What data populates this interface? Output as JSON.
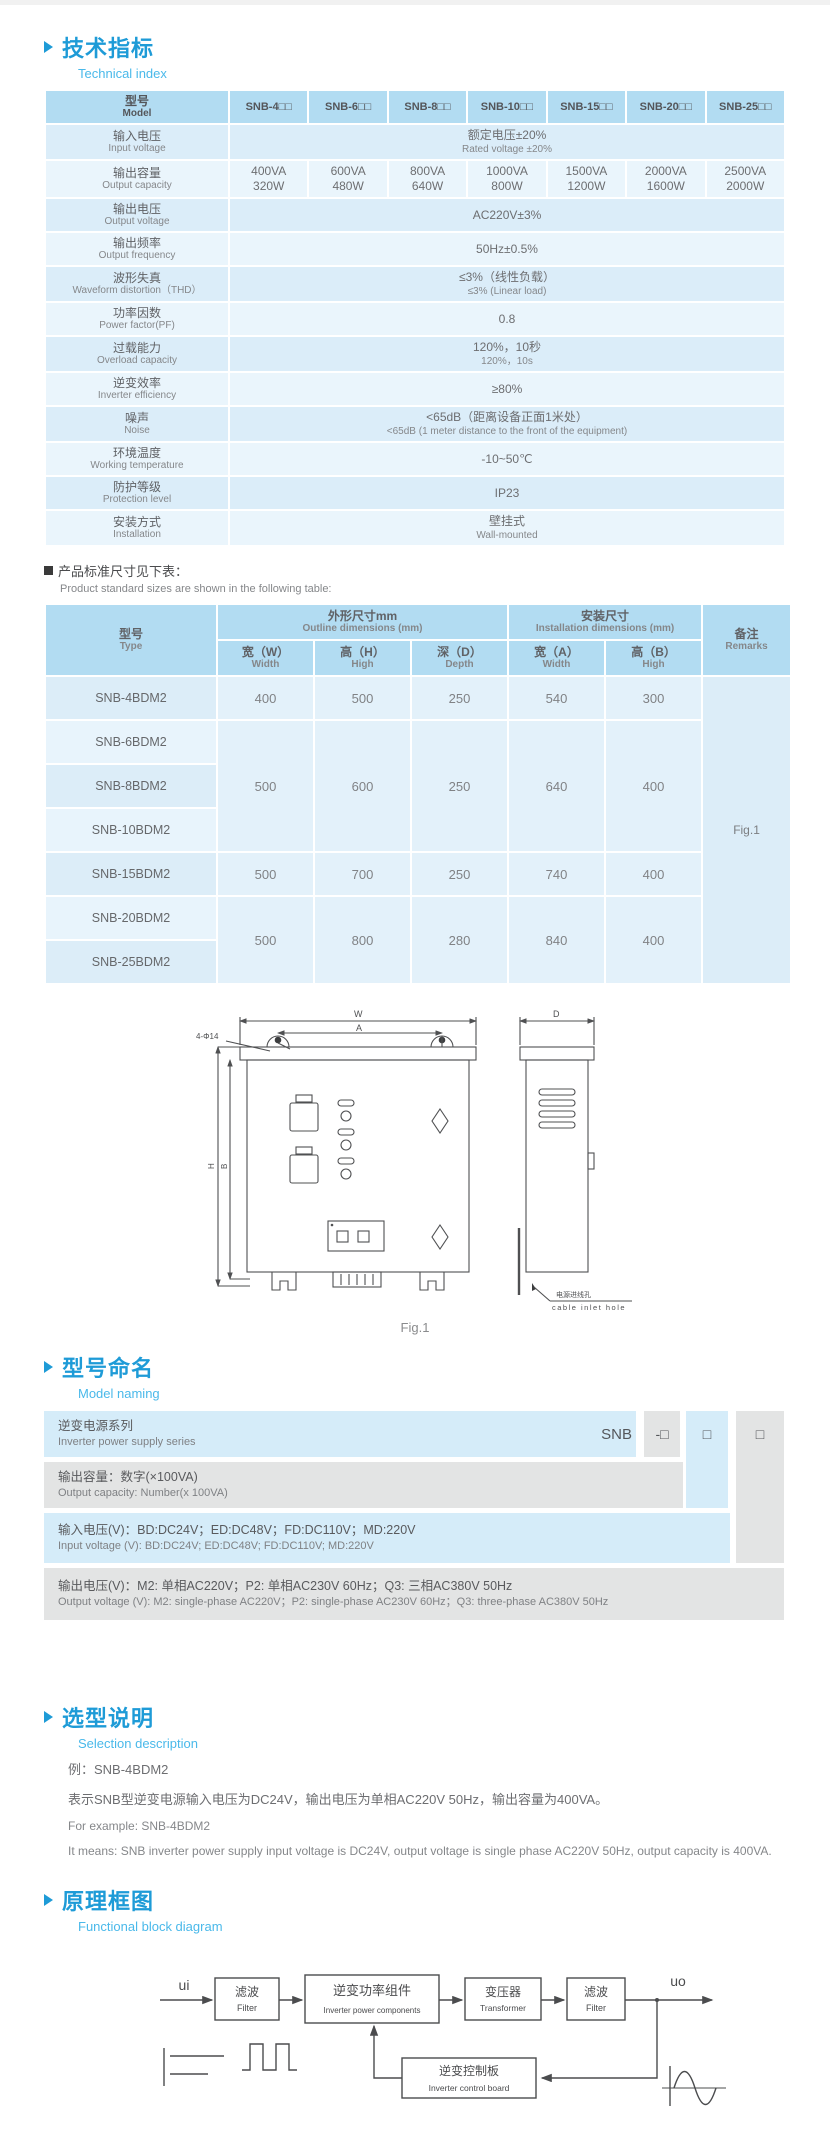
{
  "technical": {
    "title": "技术指标",
    "subtitle": "Technical index"
  },
  "spec_table": {
    "header_zh": "型号",
    "header_en": "Model",
    "models": [
      "SNB-4□□",
      "SNB-6□□",
      "SNB-8□□",
      "SNB-10□□",
      "SNB-15□□",
      "SNB-20□□",
      "SNB-25□□"
    ],
    "rows": [
      {
        "zh": "输入电压",
        "en": "Input voltage",
        "v1": "额定电压±20%",
        "v2": "Rated voltage ±20%"
      },
      {
        "zh": "输出容量",
        "en": "Output capacity"
      },
      {
        "zh": "输出电压",
        "en": "Output voltage",
        "v1": "AC220V±3%"
      },
      {
        "zh": "输出频率",
        "en": "Output frequency",
        "v1": "50Hz±0.5%"
      },
      {
        "zh": "波形失真",
        "en": "Waveform distortion（THD）",
        "v1": "≤3%（线性负载）",
        "v2": "≤3% (Linear load)"
      },
      {
        "zh": "功率因数",
        "en": "Power factor(PF)",
        "v1": "0.8"
      },
      {
        "zh": "过载能力",
        "en": "Overload capacity",
        "v1": "120%，10秒",
        "v2": "120%，10s"
      },
      {
        "zh": "逆变效率",
        "en": "Inverter efficiency",
        "v1": "≥80%"
      },
      {
        "zh": "噪声",
        "en": "Noise",
        "v1": "<65dB（距离设备正面1米处）",
        "v2": "<65dB (1 meter distance to the front of the equipment)"
      },
      {
        "zh": "环境温度",
        "en": "Working temperature",
        "v1": "-10~50℃"
      },
      {
        "zh": "防护等级",
        "en": "Protection level",
        "v1": "IP23"
      },
      {
        "zh": "安装方式",
        "en": "Installation",
        "v1": "壁挂式",
        "v2": "Wall-mounted"
      }
    ],
    "capacity": [
      [
        "400VA",
        "320W"
      ],
      [
        "600VA",
        "480W"
      ],
      [
        "800VA",
        "640W"
      ],
      [
        "1000VA",
        "800W"
      ],
      [
        "1500VA",
        "1200W"
      ],
      [
        "2000VA",
        "1600W"
      ],
      [
        "2500VA",
        "2000W"
      ]
    ]
  },
  "size_note": {
    "zh": "产品标准尺寸见下表：",
    "en": "Product standard sizes are shown in the following table:"
  },
  "dim_table": {
    "type_zh": "型号",
    "type_en": "Type",
    "outline_zh": "外形尺寸mm",
    "outline_en": "Outline dimensions (mm)",
    "install_zh": "安装尺寸",
    "install_en": "Installation dimensions (mm)",
    "remark_zh": "备注",
    "remark_en": "Remarks",
    "cols": [
      {
        "zh": "宽（W）",
        "en": "Width"
      },
      {
        "zh": "高（H）",
        "en": "High"
      },
      {
        "zh": "深（D）",
        "en": "Depth"
      },
      {
        "zh": "宽（A）",
        "en": "Width"
      },
      {
        "zh": "高（B）",
        "en": "High"
      }
    ],
    "groups": [
      {
        "m0": "SNB-4BDM2",
        "w": "400",
        "h": "500",
        "d": "250",
        "a": "540",
        "b": "300"
      },
      {
        "m0": "SNB-6BDM2",
        "m1": "SNB-8BDM2",
        "m2": "SNB-10BDM2",
        "w": "500",
        "h": "600",
        "d": "250",
        "a": "640",
        "b": "400"
      },
      {
        "m0": "SNB-15BDM2",
        "w": "500",
        "h": "700",
        "d": "250",
        "a": "740",
        "b": "400"
      },
      {
        "m0": "SNB-20BDM2",
        "m1": "SNB-25BDM2",
        "w": "500",
        "h": "800",
        "d": "280",
        "a": "840",
        "b": "400"
      }
    ],
    "remark_value": "Fig.1"
  },
  "figure": {
    "caption": "Fig.1",
    "labels": {
      "w": "W",
      "a": "A",
      "d": "D",
      "h": "H",
      "b": "B",
      "holes": "4-Φ14",
      "inlet_zh": "电源进线孔",
      "inlet_en": "cable inlet hole"
    }
  },
  "naming": {
    "title": "型号命名",
    "subtitle": "Model naming",
    "code_prefix": "SNB",
    "code_boxes": [
      "-□",
      "□",
      "□"
    ],
    "rows": [
      {
        "zh": "逆变电源系列",
        "en": "Inverter power supply series"
      },
      {
        "zh": "输出容量：数字(×100VA)",
        "en": "Output capacity: Number(x 100VA)"
      },
      {
        "zh": "输入电压(V)：BD:DC24V；ED:DC48V；FD:DC110V；MD:220V",
        "en": "Input voltage (V): BD:DC24V;  ED:DC48V;  FD:DC110V; MD:220V"
      },
      {
        "zh": "输出电压(V)：M2: 单相AC220V；P2: 单相AC230V 60Hz；Q3: 三相AC380V 50Hz",
        "en": "Output voltage (V):  M2: single-phase AC220V；P2: single-phase AC230V 60Hz；Q3: three-phase AC380V 50Hz"
      }
    ]
  },
  "selection": {
    "title": "选型说明",
    "subtitle": "Selection description",
    "example_zh": "例：SNB-4BDM2",
    "desc_zh": "表示SNB型逆变电源输入电压为DC24V，输出电压为单相AC220V 50Hz，输出容量为400VA。",
    "example_en": "For example: SNB-4BDM2",
    "desc_en": "It means: SNB inverter power supply input voltage is DC24V, output voltage is single phase AC220V 50Hz, output capacity is 400VA."
  },
  "block_diagram": {
    "title": "原理框图",
    "subtitle": "Functional block diagram",
    "input_label": "ui",
    "output_label": "uo",
    "blocks": [
      {
        "zh": "滤波",
        "en": "Filter"
      },
      {
        "zh": "逆变功率组件",
        "en": "Inverter power components"
      },
      {
        "zh": "变压器",
        "en": "Transformer"
      },
      {
        "zh": "滤波",
        "en": "Filter"
      },
      {
        "zh": "逆变控制板",
        "en": "Inverter control board"
      }
    ]
  }
}
